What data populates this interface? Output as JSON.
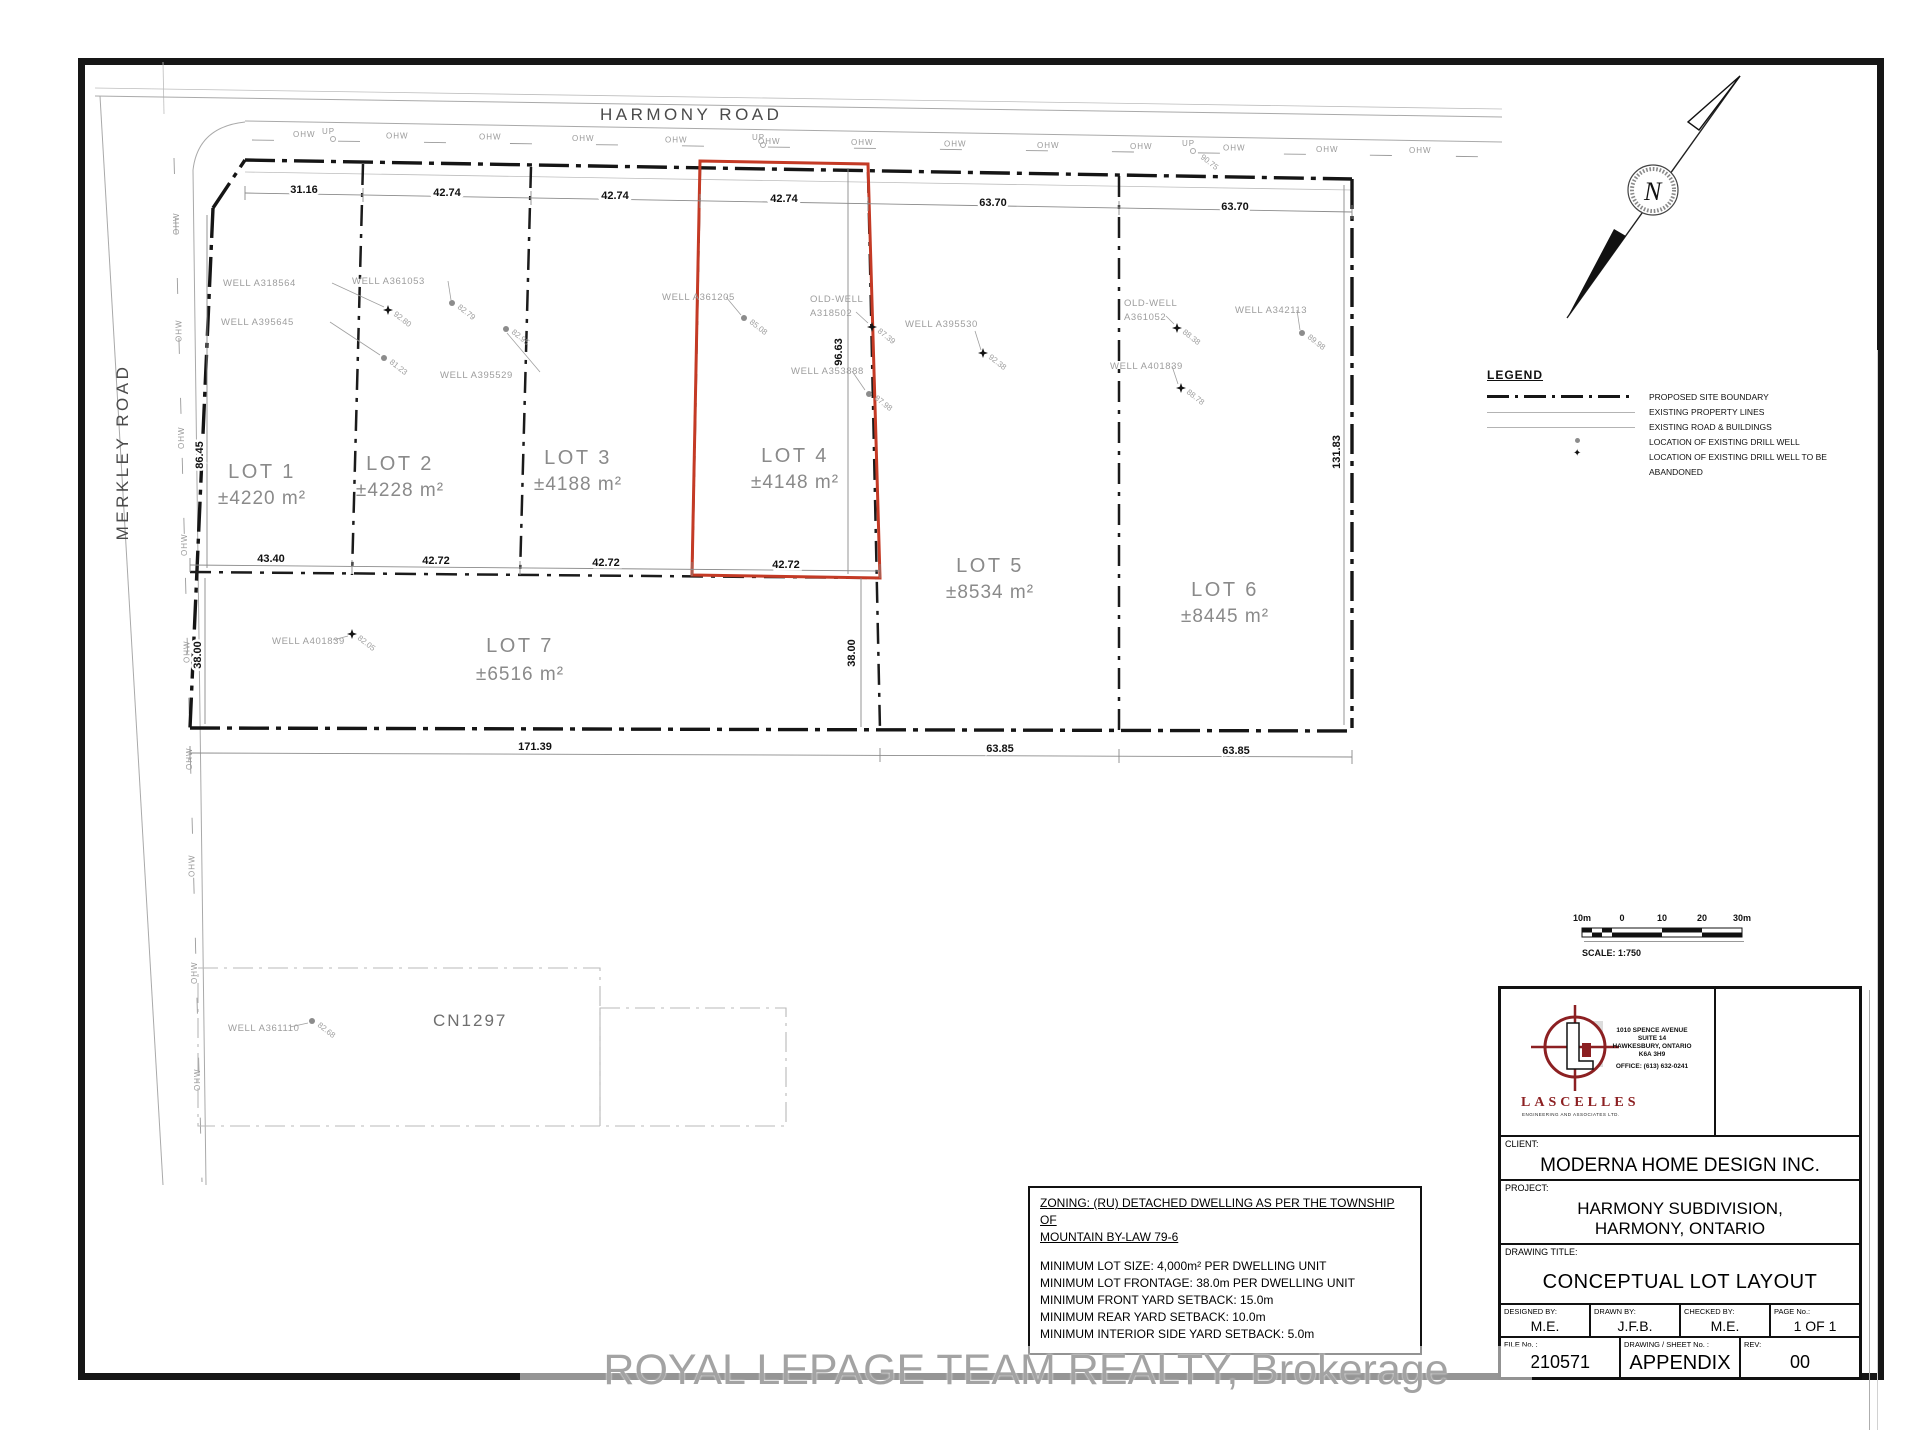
{
  "roads": {
    "harmony": "HARMONY ROAD",
    "merkley": "MERKLEY ROAD",
    "ohw_label": "OHW",
    "up_label": "UP",
    "up_elev": "90.75"
  },
  "parcel_label": "CN1297",
  "lots": [
    {
      "name": "LOT 1",
      "area": "±4220 m²"
    },
    {
      "name": "LOT 2",
      "area": "±4228 m²"
    },
    {
      "name": "LOT 3",
      "area": "±4188 m²"
    },
    {
      "name": "LOT 4",
      "area": "±4148 m²"
    },
    {
      "name": "LOT 5",
      "area": "±8534 m²"
    },
    {
      "name": "LOT 6",
      "area": "±8445 m²"
    },
    {
      "name": "LOT 7",
      "area": "±6516 m²"
    }
  ],
  "wells": [
    {
      "label": "WELL A318564",
      "elev": "92.80",
      "type": "star"
    },
    {
      "label": "WELL A395645",
      "elev": "81.23",
      "type": "dot"
    },
    {
      "label": "WELL A361053",
      "elev": "82.79",
      "type": "dot"
    },
    {
      "label": "WELL A395529",
      "elev": "82.95",
      "type": "dot"
    },
    {
      "label": "WELL A361205",
      "elev": "85.08",
      "type": "dot"
    },
    {
      "label": "OLD-WELL",
      "label2": "A318502",
      "elev": "87.39",
      "type": "star"
    },
    {
      "label": "WELL A353888",
      "elev": "87.98",
      "type": "dot"
    },
    {
      "label": "WELL A395530",
      "elev": "92.38",
      "type": "star"
    },
    {
      "label": "OLD-WELL",
      "label2": "A361052",
      "elev": "88.38",
      "type": "star"
    },
    {
      "label": "WELL A401839",
      "elev": "88.78",
      "type": "star"
    },
    {
      "label": "WELL A342113",
      "elev": "89.98",
      "type": "dot"
    },
    {
      "label": "WELL A401839",
      "elev": "82.05",
      "type": "star"
    },
    {
      "label": "WELL A361110",
      "elev": "82.68",
      "type": "dot"
    }
  ],
  "dimensions": {
    "top": [
      "31.16",
      "42.74",
      "42.74",
      "42.74",
      "63.70",
      "63.70"
    ],
    "mid": [
      "43.40",
      "42.72",
      "42.72",
      "42.72"
    ],
    "bottom": [
      "171.39",
      "63.85",
      "63.85"
    ],
    "left_upper": "86.45",
    "left_lower": "38.00",
    "lot4_depth": "96.63",
    "lot7_depth_right": "38.00",
    "right_side": "131.83"
  },
  "legend": {
    "title": "LEGEND",
    "items": [
      "PROPOSED SITE BOUNDARY",
      "EXISTING PROPERTY LINES",
      "EXISTING ROAD & BUILDINGS",
      "LOCATION OF EXISTING DRILL WELL",
      "LOCATION OF EXISTING DRILL WELL TO BE",
      "ABANDONED"
    ]
  },
  "zoning": {
    "heading1": "ZONING: (RU) DETACHED DWELLING AS PER THE TOWNSHIP OF",
    "heading2": "MOUNTAIN BY-LAW 79-6",
    "rules": [
      "MINIMUM LOT SIZE:    4,000m² PER DWELLING UNIT",
      "MINIMUM LOT FRONTAGE:    38.0m PER DWELLING UNIT",
      "MINIMUM FRONT YARD SETBACK:    15.0m",
      "MINIMUM REAR YARD SETBACK:    10.0m",
      "MINIMUM INTERIOR SIDE YARD SETBACK:   5.0m"
    ]
  },
  "scale_bar": {
    "ticks": [
      "10m",
      "0",
      "10",
      "20",
      "30m"
    ],
    "label": "SCALE: 1:750"
  },
  "north": {
    "label": "N"
  },
  "title_block": {
    "company": "LASCELLES",
    "company_sub": "ENGINEERING AND ASSOCIATES LTD.",
    "address1": "1010 SPENCE AVENUE",
    "address2": "SUITE 14",
    "address3": "HAWKESBURY, ONTARIO",
    "address4": "K6A 3H9",
    "office": "OFFICE:   (613) 632-0241",
    "client_label": "CLIENT:",
    "client": "MODERNA HOME DESIGN INC.",
    "project_label": "PROJECT:",
    "project1": "HARMONY SUBDIVISION,",
    "project2": "HARMONY, ONTARIO",
    "drawing_title_label": "DRAWING TITLE:",
    "drawing_title": "CONCEPTUAL LOT LAYOUT",
    "designed_label": "DESIGNED BY:",
    "designed": "M.E.",
    "drawn_label": "DRAWN BY:",
    "drawn": "J.F.B.",
    "checked_label": "CHECKED BY:",
    "checked": "M.E.",
    "page_label": "PAGE No.:",
    "page": "1 OF 1",
    "file_label": "FILE No. :",
    "file": "210571",
    "sheet_label": "DRAWING / SHEET No. :",
    "sheet": "APPENDIX",
    "rev_label": "REV:",
    "rev": "00"
  },
  "watermark": "ROYAL LEPAGE TEAM REALTY, Brokerage"
}
